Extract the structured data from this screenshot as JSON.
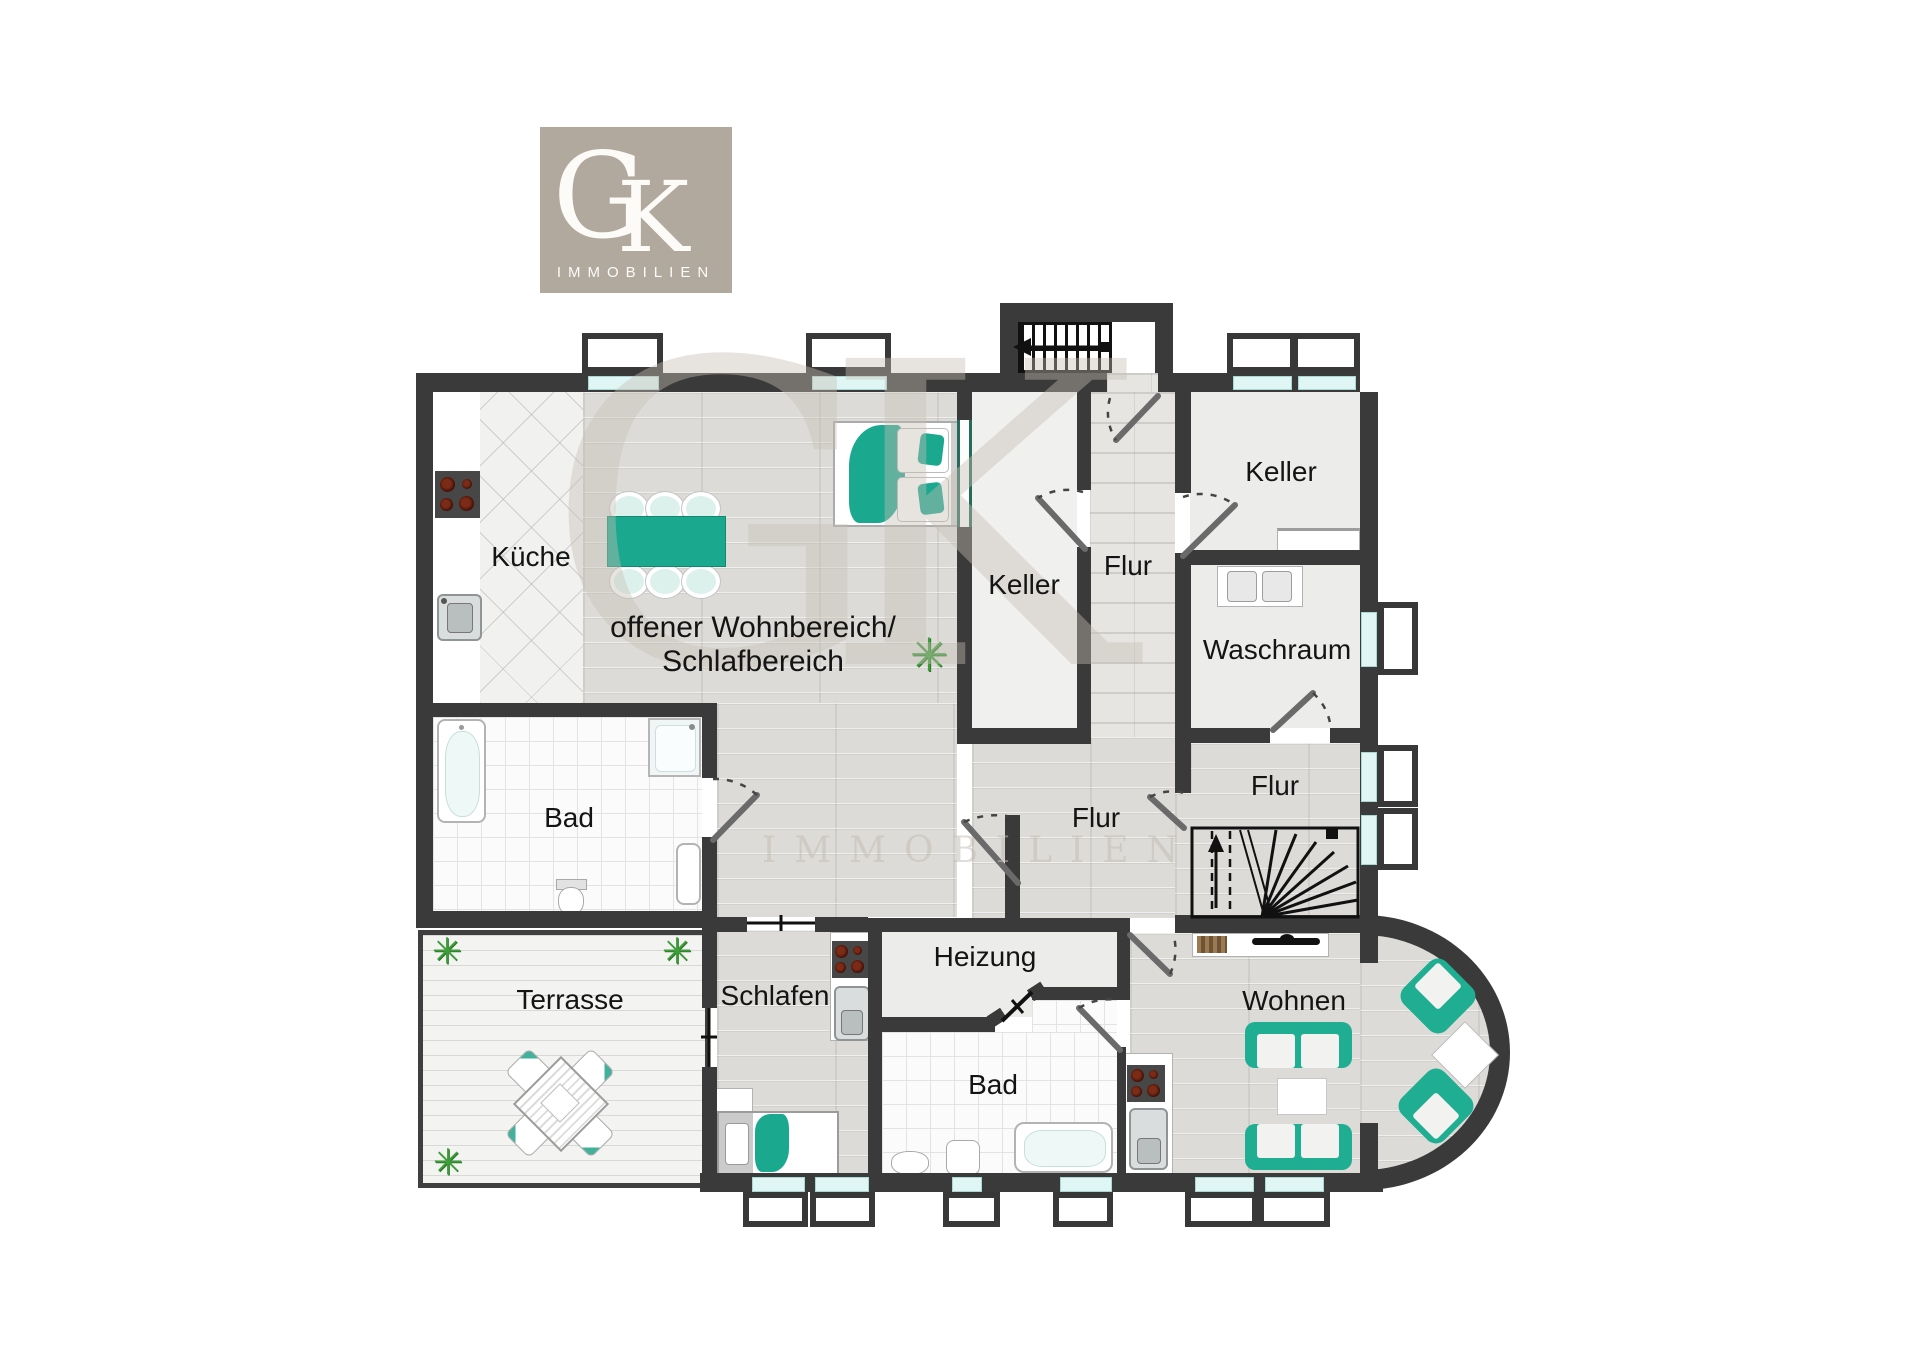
{
  "brand": {
    "monogram_g": "G",
    "monogram_k": "K",
    "wordmark": "IMMOBILIEN"
  },
  "watermark": {
    "monogram": "GK",
    "wordmark": "IMMOBILIEN"
  },
  "rooms": {
    "kueche": {
      "label": "Küche"
    },
    "wohnbereich": {
      "line1": "offener Wohnbereich/",
      "line2": "Schlafbereich"
    },
    "keller_links": {
      "label": "Keller"
    },
    "flur_oben": {
      "label": "Flur"
    },
    "keller_rechts": {
      "label": "Keller"
    },
    "waschraum": {
      "label": "Waschraum"
    },
    "flur_rechts": {
      "label": "Flur"
    },
    "flur_mitte": {
      "label": "Flur"
    },
    "bad_oben": {
      "label": "Bad"
    },
    "terrasse": {
      "label": "Terrasse"
    },
    "schlafen": {
      "label": "Schlafen"
    },
    "heizung": {
      "label": "Heizung"
    },
    "bad_unten": {
      "label": "Bad"
    },
    "wohnen": {
      "label": "Wohnen"
    }
  },
  "icons": {
    "plant": "✳"
  },
  "colors": {
    "wall": "#3a3a3a",
    "accent_teal": "#1fae92",
    "window_glass": "#dff6f4",
    "logo_bg": "#b1a89e",
    "plant_green": "#3f9e3b"
  }
}
